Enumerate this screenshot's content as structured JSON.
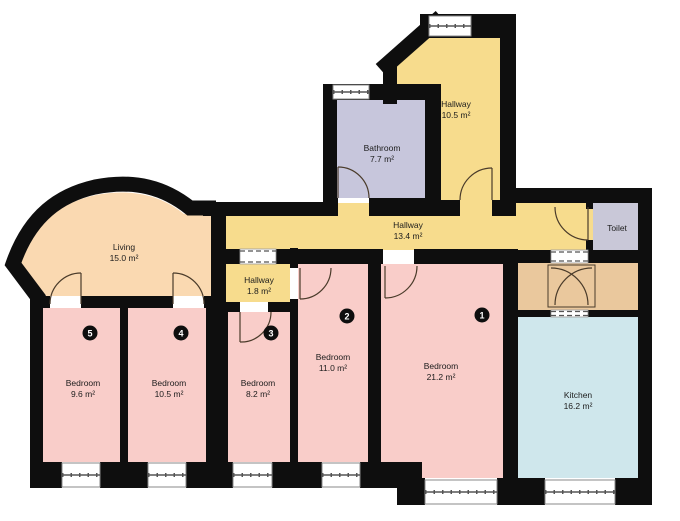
{
  "colors": {
    "hallway": "#f7dc8d",
    "bathroom": "#c7c6dc",
    "toilet": "#c9c8d8",
    "bedroom": "#f9cdc9",
    "living": "#fad9b1",
    "kitchen": "#cfe7ec",
    "vestibule": "#eac89d",
    "wall": "#0e0e0e"
  },
  "rooms": {
    "hallway_upper": {
      "label": "Hallway",
      "area": "10.5 m²"
    },
    "bathroom": {
      "label": "Bathroom",
      "area": "7.7 m²"
    },
    "hallway_main": {
      "label": "Hallway",
      "area": "13.4 m²"
    },
    "toilet": {
      "label": "Toilet"
    },
    "living": {
      "label": "Living",
      "area": "15.0 m²"
    },
    "hallway_small": {
      "label": "Hallway",
      "area": "1.8 m²"
    },
    "bedroom1": {
      "label": "Bedroom",
      "area": "21.2 m²",
      "number": "1"
    },
    "bedroom2": {
      "label": "Bedroom",
      "area": "11.0 m²",
      "number": "2"
    },
    "bedroom3": {
      "label": "Bedroom",
      "area": "8.2 m²",
      "number": "3"
    },
    "bedroom4": {
      "label": "Bedroom",
      "area": "10.5 m²",
      "number": "4"
    },
    "bedroom5": {
      "label": "Bedroom",
      "area": "9.6 m²",
      "number": "5"
    },
    "kitchen": {
      "label": "Kitchen",
      "area": "16.2 m²"
    }
  }
}
